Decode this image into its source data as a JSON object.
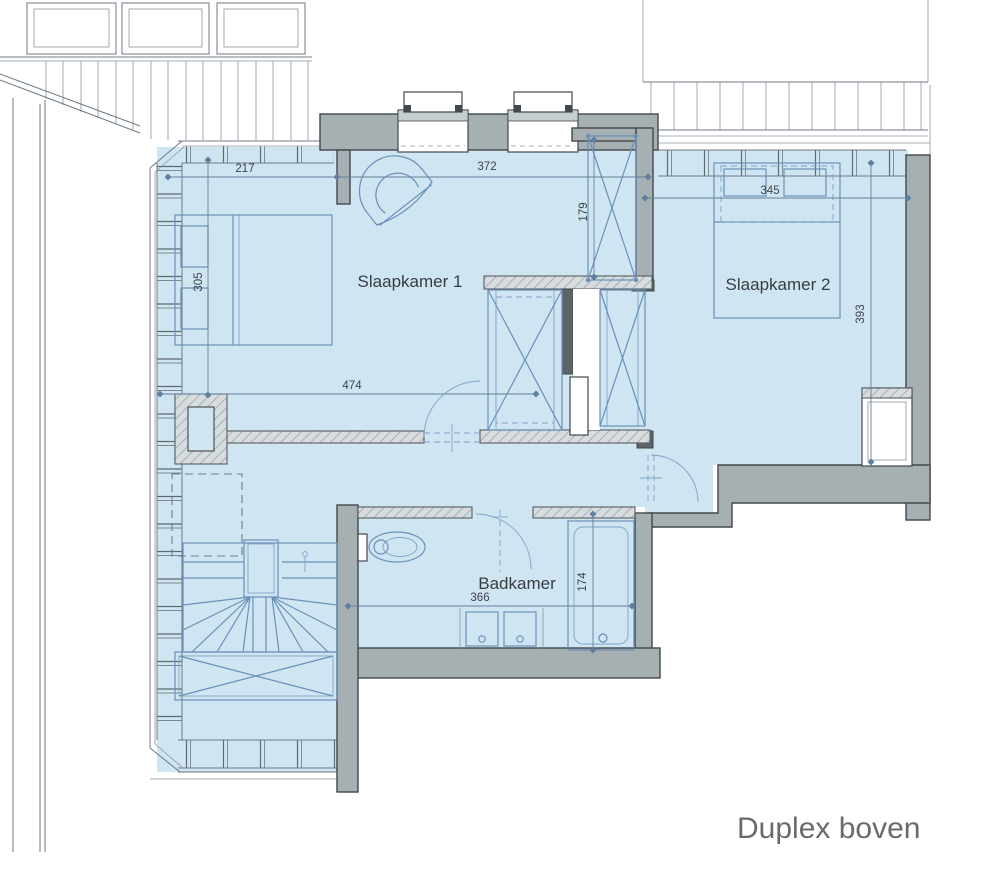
{
  "title": "Duplex boven",
  "rooms": {
    "slaapkamer1": "Slaapkamer 1",
    "slaapkamer2": "Slaapkamer 2",
    "badkamer": "Badkamer"
  },
  "dims": {
    "d217": "217",
    "d372": "372",
    "d305": "305",
    "d179": "179",
    "d345": "345",
    "d393": "393",
    "d474": "474",
    "d366": "366",
    "d174": "174"
  },
  "colors": {
    "room_fill": "#cfe5f1",
    "wall": "#a6b0b3",
    "furniture_line": "#6a90ba",
    "dimension_line": "#64809c",
    "dimension_text": "#3f444a",
    "title_text": "#686b6e"
  }
}
